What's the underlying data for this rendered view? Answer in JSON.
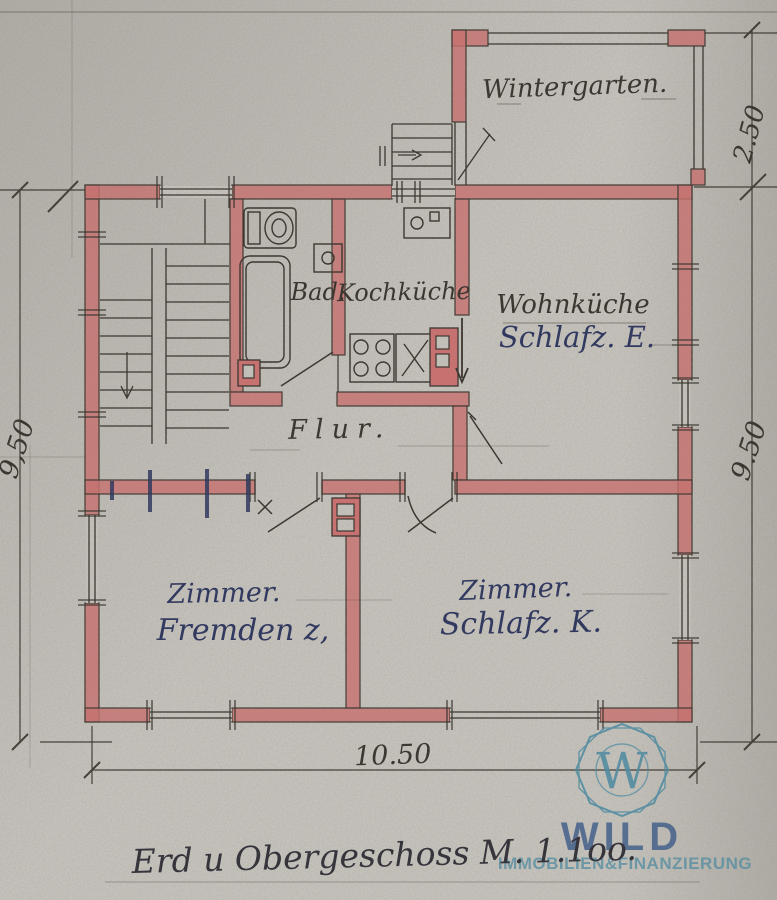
{
  "plan_labels": {
    "wintergarten": "Wintergarten.",
    "bad": "Bad.",
    "kochkueche": "Kochküche",
    "wohnkueche": "Wohnküche",
    "wohnkueche_sub": "Schlafz. E.",
    "flur": "Flur.",
    "zimmer_links": "Zimmer.",
    "zimmer_links_sub": "Fremden z,",
    "zimmer_rechts": "Zimmer.",
    "zimmer_rechts_sub": "Schlafz. K."
  },
  "dimensions": {
    "wintergarten_tiefe": "2.50",
    "links": "9,50",
    "rechts": "9.50",
    "unten": "10.50"
  },
  "caption": "Erd u Obergeschoss M. 1.1oo.",
  "watermark": {
    "monogram": "W",
    "brand": "WILD",
    "tagline": "IMMOBILIEN&FINANZIERUNG"
  },
  "colors": {
    "paper": "#cac7c1",
    "wall": "#d0706f",
    "ink": "#332d27",
    "blue_ink": "#27305c",
    "logo_teal": "#4a8da6",
    "logo_blue": "#41608e"
  }
}
